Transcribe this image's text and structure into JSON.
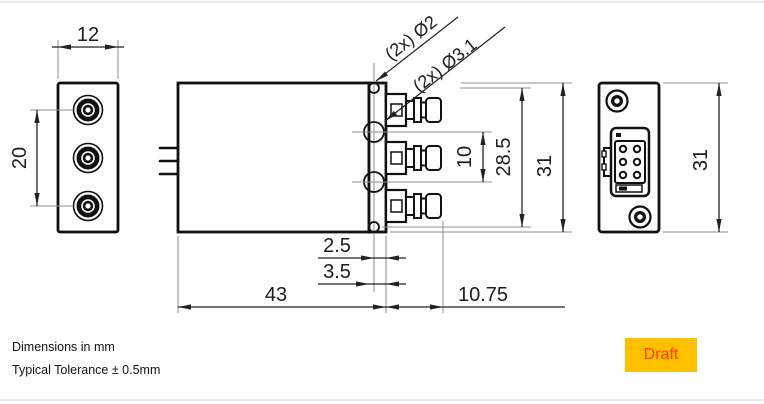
{
  "title": "connector-module-technical-drawing",
  "notes": {
    "units": "Dimensions in mm",
    "tolerance": "Typical Tolerance ± 0.5mm"
  },
  "badge": {
    "label": "Draft"
  },
  "colors": {
    "badge_bg": "#FFC000",
    "badge_text": "#FF3B00",
    "outline": "#111111",
    "dimension_line": "#222222",
    "extension_line": "#8f8f8f"
  },
  "dimensions": {
    "front_width": "12",
    "front_connector_pitch": "20",
    "pilot_hole_callout": "(2x) Ø2",
    "connector_hole_callout": "(2x) Ø3.1",
    "rf_connector_pitch": "10",
    "pilot_hole_pitch": "28.5",
    "side_height": "31",
    "hole_face_offset": "2.5",
    "flange_thickness": "3.5",
    "body_length": "43",
    "connector_protrusion": "10.75",
    "rear_height": "31"
  }
}
